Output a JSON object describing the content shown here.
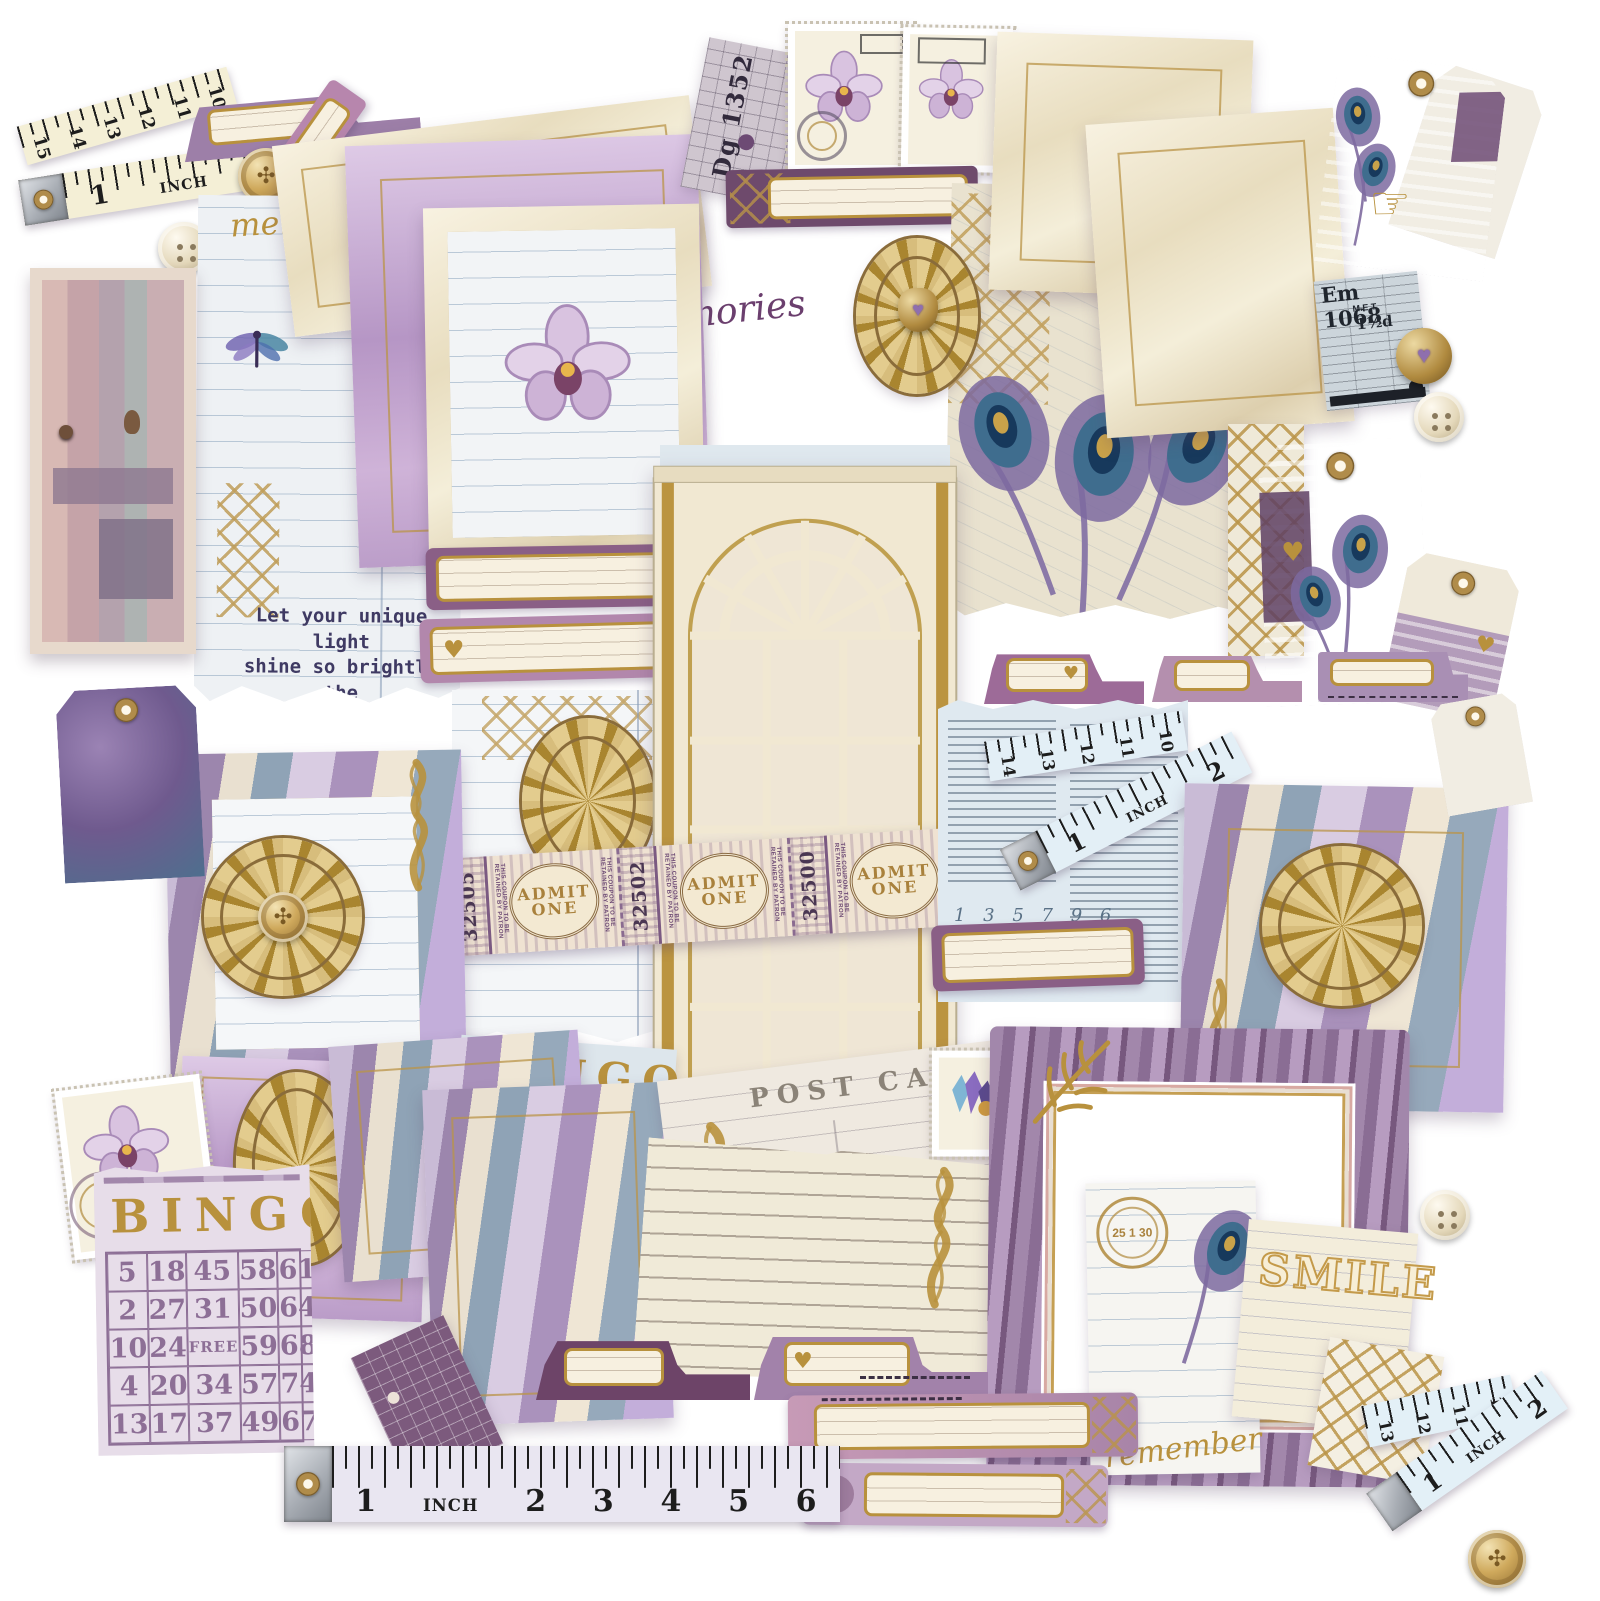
{
  "palette": {
    "gold": "#b8913d",
    "deep_purple": "#6d4a74",
    "lavender": "#c0a5cb",
    "cream": "#f3ecd9",
    "plum_bar": "#7a4f76",
    "blue_page": "#dfe9f0"
  },
  "texts": {
    "quote": "Let your unique light\nshine so brightly the\nworld can see it",
    "memories_script": "memories",
    "make_label": "MAKE",
    "the_memories_script": "the memories",
    "post_card": "POST CARD",
    "smile": "SMILE",
    "remember": "remember",
    "bingo_title": "BINGO",
    "free_cell": "FREE",
    "inch": "INCH",
    "admit_line1": "ADMIT",
    "admit_line2": "ONE",
    "coupon_text": "THIS COUPON TO BE RETAINED BY PATRON",
    "music_number": "59",
    "music_title": "Blessed Assurance.",
    "music_author": "Fanny J. Crosby.",
    "postmark_date": "25 1 30",
    "pointing_hand": "☞",
    "heart": "♥"
  },
  "tickets": {
    "admit_numbers": [
      "32505",
      "32502",
      "32500"
    ],
    "tram_top_prefix": "Dg",
    "tram_top_number": "1352",
    "tram_right_prefix": "Em",
    "tram_right_number": "1068",
    "tram_right_company": "M.E.T.",
    "tram_right_fare": "1½d"
  },
  "rulers": {
    "top_fold": [
      "15",
      "14",
      "13",
      "12",
      "11",
      "10"
    ],
    "top_main": [
      "1",
      "2"
    ],
    "bottom_main": [
      "1",
      "2",
      "3",
      "4",
      "5",
      "6"
    ],
    "mid_blue_fold": [
      "14",
      "13",
      "12",
      "11",
      "10"
    ],
    "mid_blue_main": [
      "1",
      "2"
    ],
    "br_fold": [
      "13",
      "12",
      "11",
      "10"
    ],
    "br_main": [
      "1",
      "2"
    ]
  },
  "bingo_lavender": {
    "rows": [
      [
        "5",
        "18",
        "45",
        "58",
        "61"
      ],
      [
        "2",
        "27",
        "31",
        "50",
        "64"
      ],
      [
        "10",
        "24",
        "FREE",
        "59",
        "68"
      ],
      [
        "4",
        "20",
        "34",
        "57",
        "74"
      ],
      [
        "13",
        "17",
        "37",
        "49",
        "67"
      ]
    ]
  },
  "bingo_blue": {
    "rows": [
      [
        "5",
        "20",
        "3",
        "0",
        ""
      ],
      [
        "14",
        "26",
        "3",
        "0",
        "7"
      ],
      [
        "7",
        "16",
        "",
        "",
        ""
      ],
      [
        "5",
        "28",
        "1",
        "5",
        "52"
      ]
    ]
  },
  "bluepage": {
    "number_rows": [
      "1 3 5 7 9 6",
      "4 2 4 2 9 1",
      "7 6 1 4 7 1"
    ]
  }
}
